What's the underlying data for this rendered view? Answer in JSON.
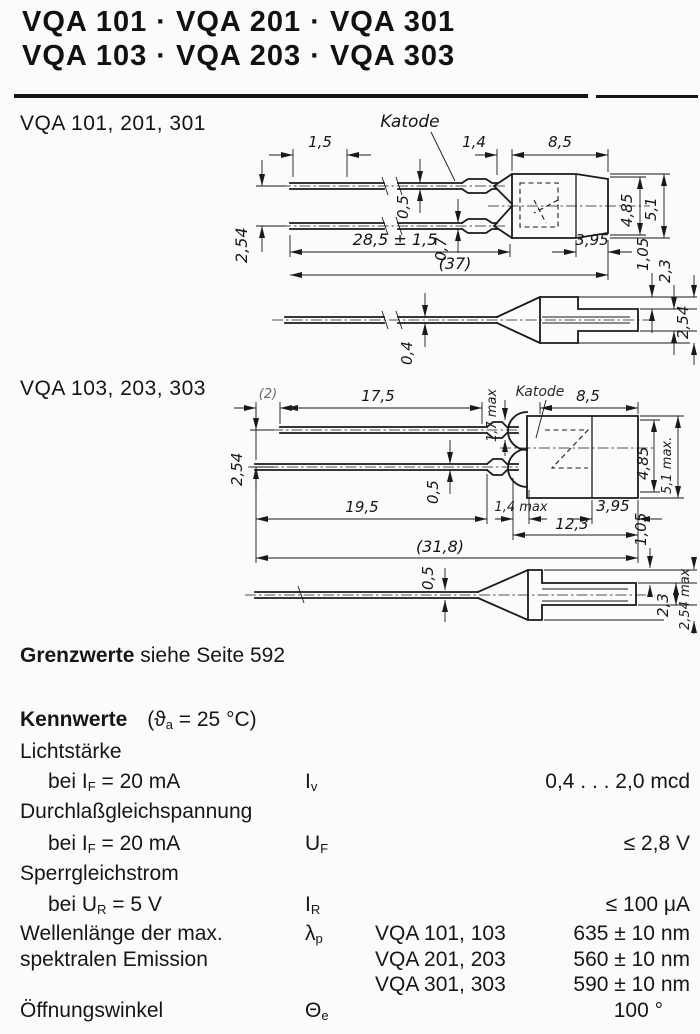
{
  "page": {
    "title_line1": "VQA 101 · VQA 201 · VQA 301",
    "title_line2": "VQA 103 · VQA 203 · VQA 303"
  },
  "drawing1": {
    "title": "VQA 101, 201, 301",
    "katode": "Katode",
    "dim_lead_offset": "1,5",
    "dim_flange": "1,4",
    "dim_body_length": "8,5",
    "dim_lead_pitch": "2,54",
    "dim_lead_thickness_top": "0,5",
    "dim_lead_thickness_bottom": "0,7",
    "dim_lead_length": "28,5 ± 1,5",
    "dim_overall": "(37)",
    "dim_dia_inner": "4,85",
    "dim_dia_outer": "5,1",
    "dim_front": "3,95",
    "dim_step": "1,05",
    "dim_notch": "2,3",
    "dim_side_lead": "0,4",
    "dim_side_pitch": "2,54"
  },
  "drawing2": {
    "title": "VQA 103, 203, 303",
    "katode": "Katode",
    "dim_lead_offset": "(2)",
    "dim_top_lead": "17,5",
    "dim_tip": "1,7 max",
    "dim_body_length": "8,5",
    "dim_lead_pitch": "2,54",
    "dim_lead_thickness": "0,5",
    "dim_bottom_lead": "19,5",
    "dim_flange": "1,4 max",
    "dim_front": "3,95",
    "dim_body_total": "12,3",
    "dim_overall": "(31,8)",
    "dim_dia_inner": "4,85",
    "dim_dia_outer": "5,1 max.",
    "dim_side_lead": "0,5",
    "dim_step": "1,05",
    "dim_notch": "2,3",
    "dim_side_max": "2,54 max"
  },
  "grenzwerte": {
    "label": "Grenzwerte",
    "text": "siehe Seite 592"
  },
  "kennwerte": {
    "heading": "Kennwerte",
    "cond_pre": "(ϑ",
    "cond_sub": "a",
    "cond_post": " = 25 °C)",
    "lichtstaerke": {
      "label": "Lichtstärke",
      "cond_pre": "bei I",
      "cond_sub": "F",
      "cond_post": " = 20 mA",
      "sym_pre": "I",
      "sym_sub": "v",
      "value": "0,4 . . . 2,0 mcd"
    },
    "durchlass": {
      "label": "Durchlaßgleichspannung",
      "cond_pre": "bei I",
      "cond_sub": "F",
      "cond_post": " = 20 mA",
      "sym_pre": "U",
      "sym_sub": "F",
      "value": "≤ 2,8 V"
    },
    "sperr": {
      "label": "Sperrgleichstrom",
      "cond_pre": "bei U",
      "cond_sub": "R",
      "cond_post": " = 5 V",
      "sym_pre": "I",
      "sym_sub": "R",
      "value": "≤ 100 μA"
    },
    "wellenlaenge": {
      "label_line1": "Wellenlänge der max.",
      "label_line2": "spektralen Emission",
      "sym_pre": "λ",
      "sym_sub": "p",
      "variants": [
        {
          "type": "VQA 101, 103",
          "value": "635 ± 10 nm"
        },
        {
          "type": "VQA 201, 203",
          "value": "560 ± 10 nm"
        },
        {
          "type": "VQA 301, 303",
          "value": "590 ± 10 nm"
        }
      ]
    },
    "oeffnungswinkel": {
      "label": "Öffnungswinkel",
      "sym_pre": "Θ",
      "sym_sub": "e",
      "value": "100 °"
    }
  }
}
